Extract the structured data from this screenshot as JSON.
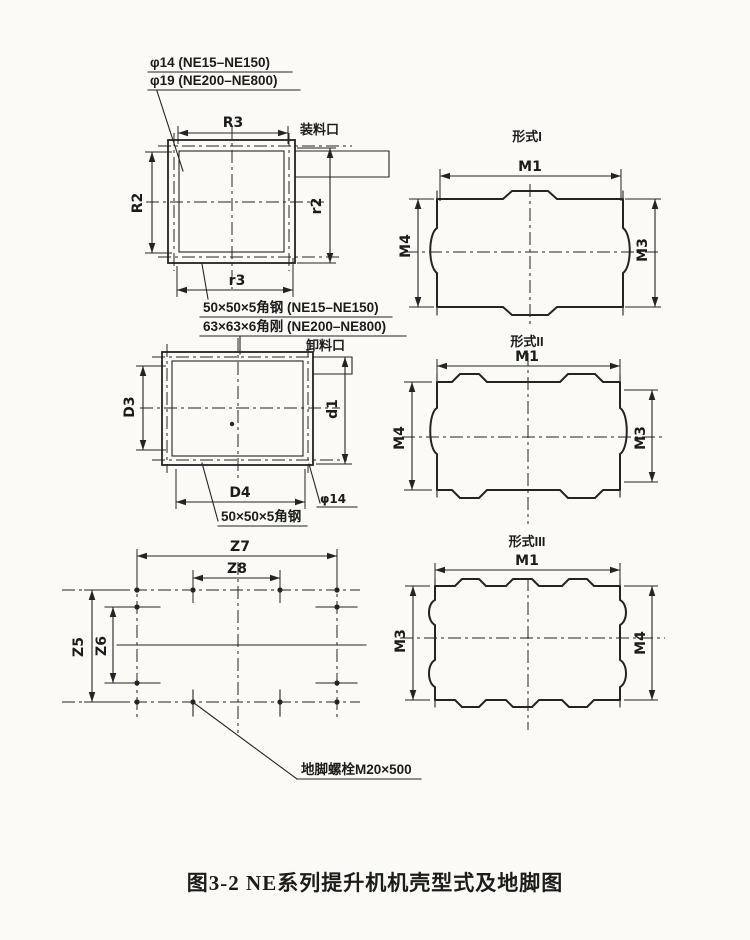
{
  "colors": {
    "paper": "#fbfaf7",
    "ink": "#242424"
  },
  "caption": "图3-2  NE系列提升机机壳型式及地脚图",
  "top_note": {
    "line1": "φ14 (NE15–NE150)",
    "line2": "φ19 (NE200–NE800)"
  },
  "square_view": {
    "port": "装料口",
    "dim_top": "R3",
    "dim_left": "R2",
    "dim_right": "r2",
    "dim_bottom": "r3",
    "note1": "50×50×5角钢 (NE15–NE150)",
    "note2": "63×63×6角刚 (NE200–NE800)"
  },
  "rect_view": {
    "port": "卸料口",
    "dim_left": "D3",
    "dim_right": "d1",
    "dim_bottom": "D4",
    "hole": "φ14",
    "note": "50×50×5角钢"
  },
  "foundation_view": {
    "dim_top_outer": "Z7",
    "dim_top_inner": "Z8",
    "dim_left_outer": "Z5",
    "dim_left_inner": "Z6",
    "bolt_note": "地脚螺栓M20×500"
  },
  "shell_types": [
    {
      "title": "形式I",
      "dim_top": "M1",
      "dim_left": "M4",
      "dim_right": "M3"
    },
    {
      "title": "形式II",
      "dim_top": "M1",
      "dim_left": "M4",
      "dim_right": "M3"
    },
    {
      "title": "形式III",
      "dim_top": "M1",
      "dim_left": "M3",
      "dim_right": "M4"
    }
  ]
}
